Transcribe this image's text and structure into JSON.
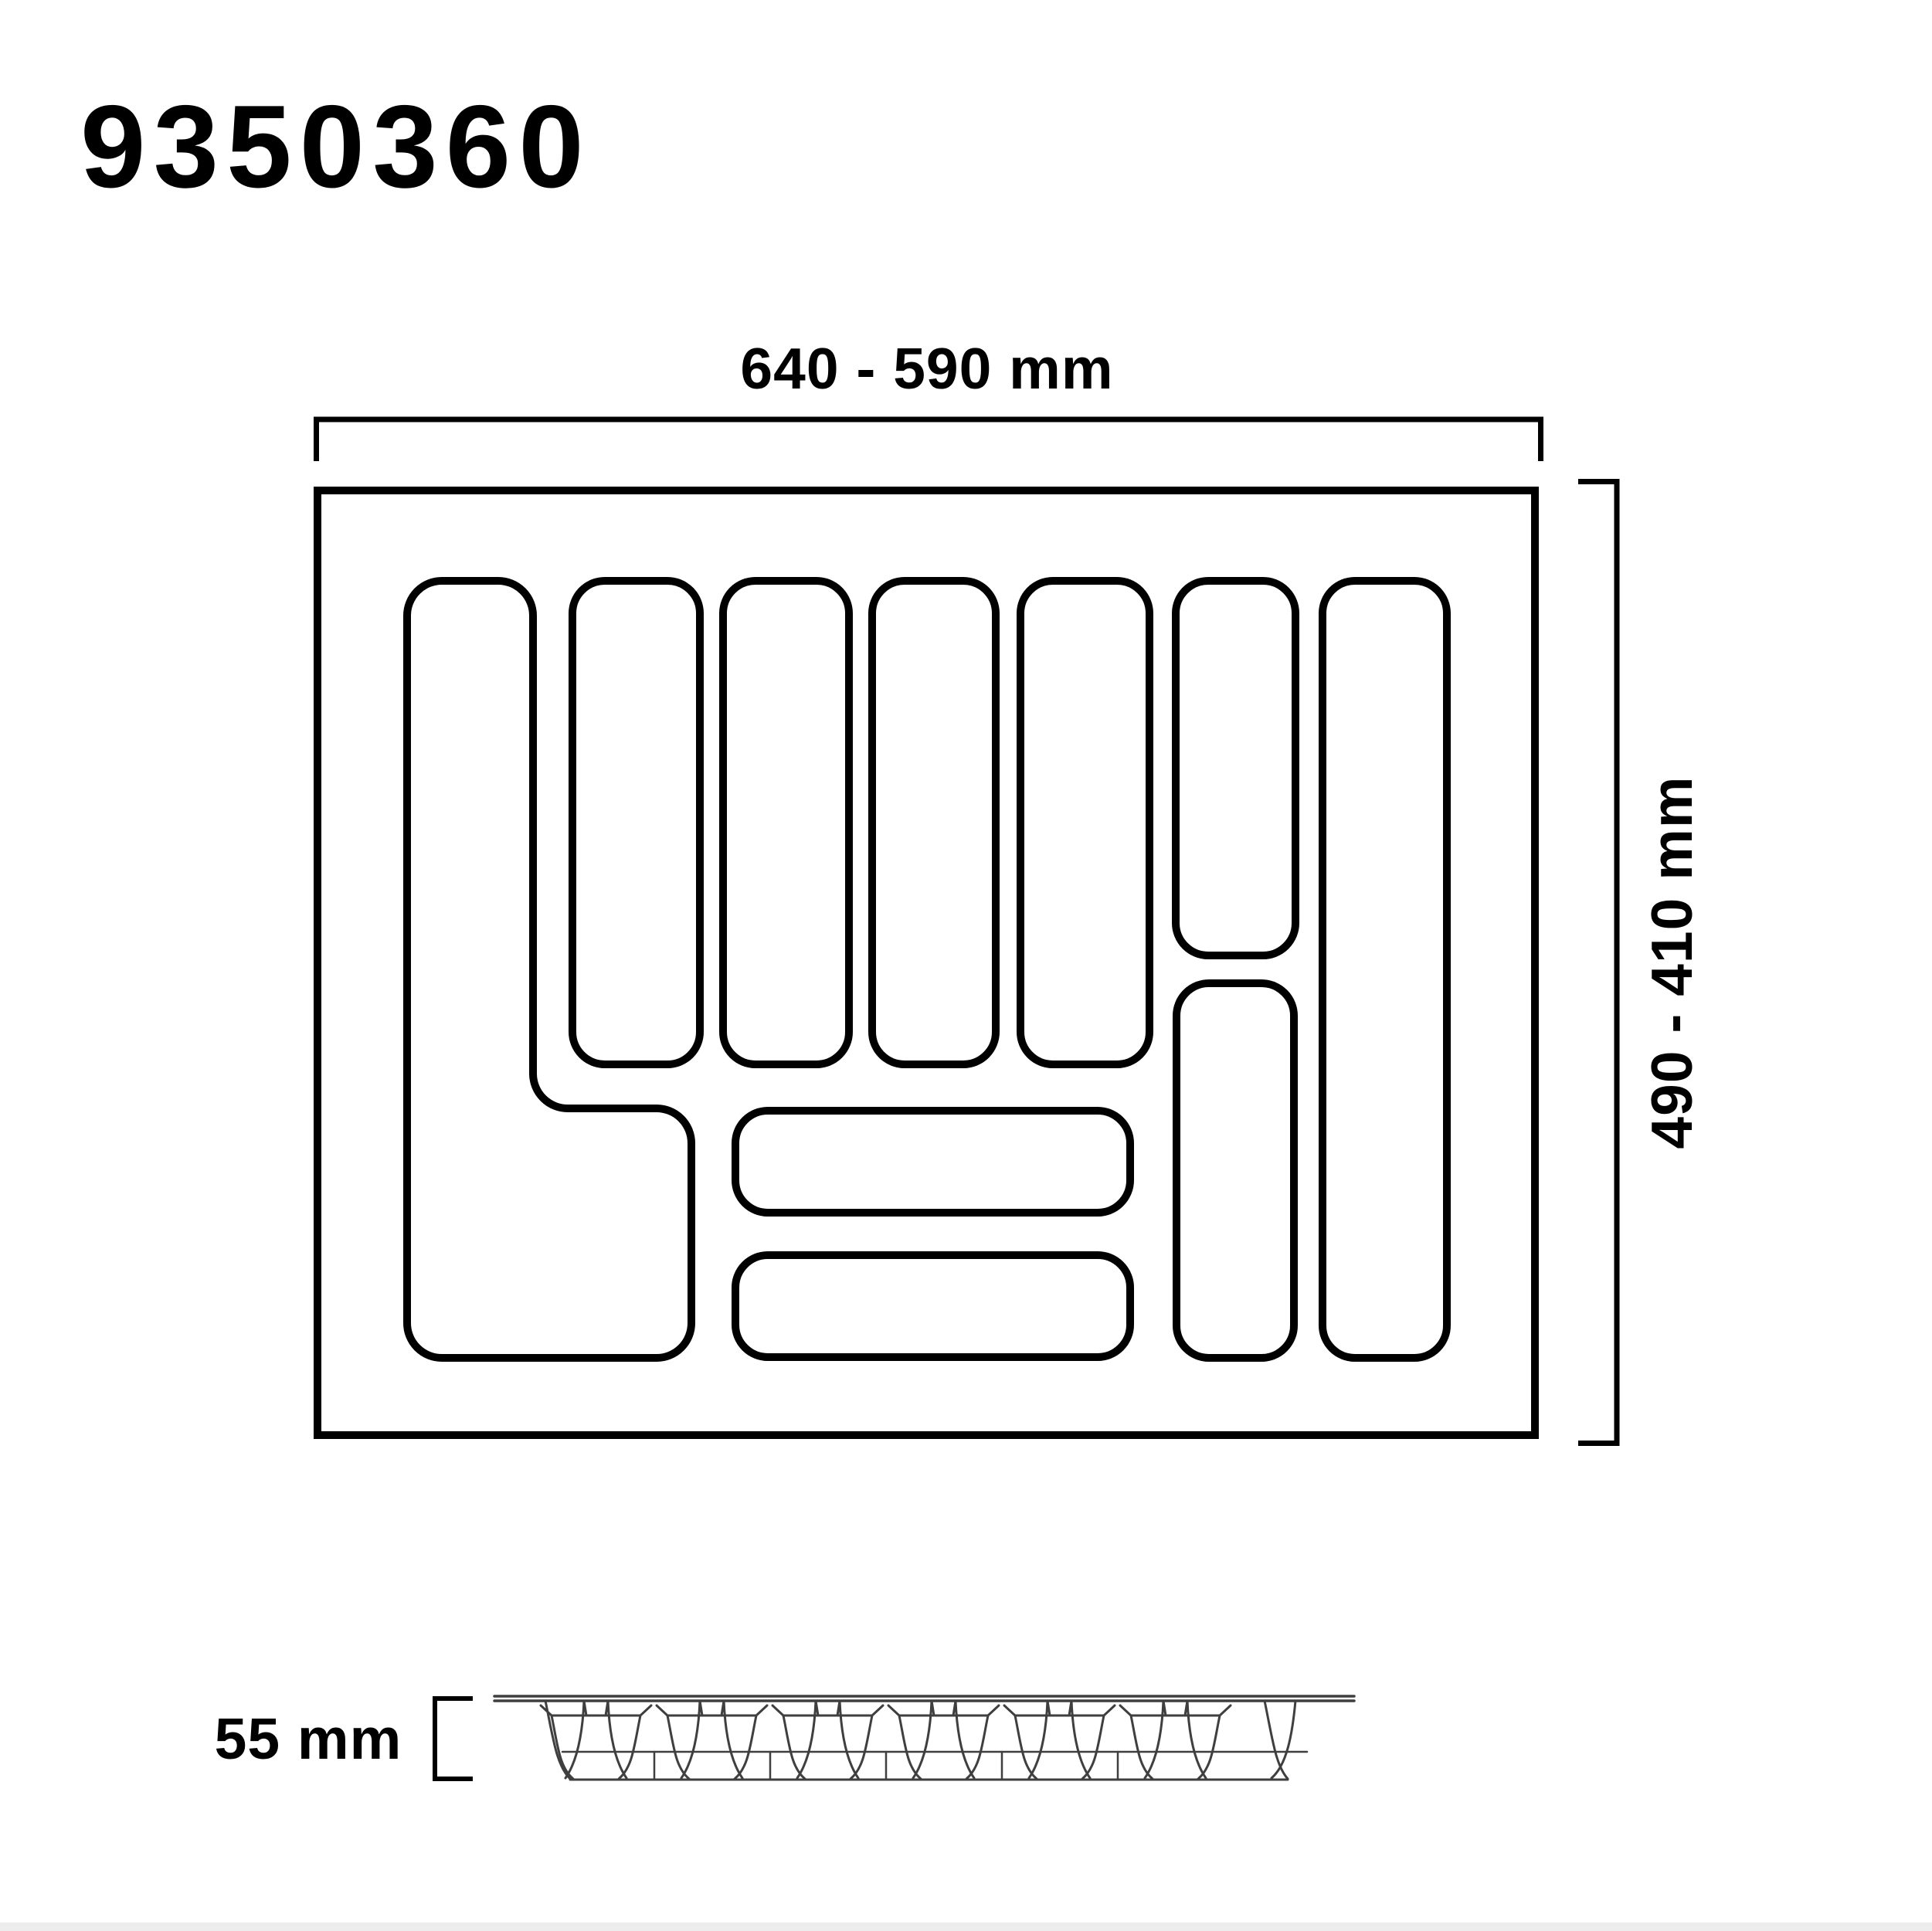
{
  "page": {
    "title": "9350360"
  },
  "top_view": {
    "width_label": "640 - 590 mm",
    "height_label": "490 - 410 mm"
  },
  "side_view": {
    "height_label": "55 mm"
  },
  "colors": {
    "drawing_line": "#000000",
    "side_profile_line": "#3f3f3f",
    "footer_strip": "#ededee"
  }
}
